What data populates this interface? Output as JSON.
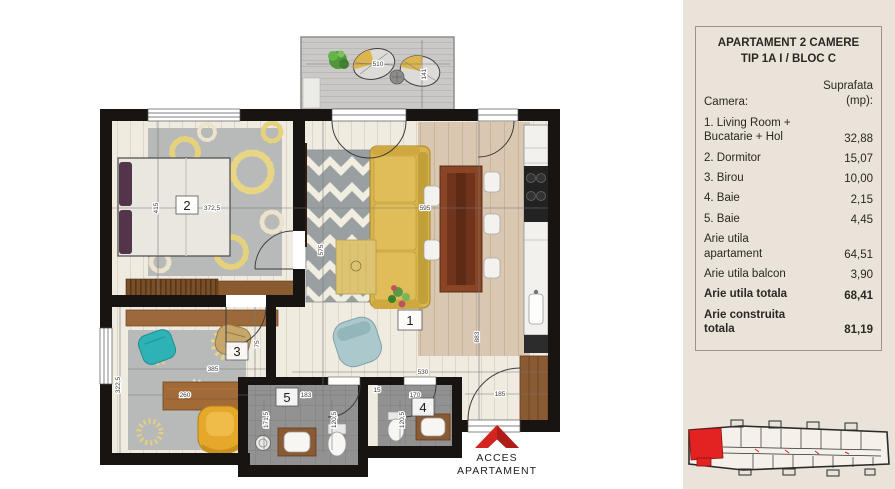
{
  "colors": {
    "accent_red": "#d42420",
    "panel_beige": "#eae3da",
    "wall_black": "#171412",
    "wood": "#9c6a3a",
    "sofa_yellow": "#d8b44b",
    "rug_gray": "#b7bab9"
  },
  "side_panel": {
    "title_line1": "APARTAMENT 2 CAMERE",
    "title_line2": "TIP 1A I / BLOC C",
    "header_camera": "Camera:",
    "header_area_line1": "Suprafata",
    "header_area_line2": "(mp):",
    "rows": [
      {
        "label": "1. Living Room +\nBucatarie + Hol",
        "value": "32,88"
      },
      {
        "label": "2. Dormitor",
        "value": "15,07"
      },
      {
        "label": "3. Birou",
        "value": "10,00"
      },
      {
        "label": "4. Baie",
        "value": "2,15"
      },
      {
        "label": "5. Baie",
        "value": "4,45"
      },
      {
        "label": "Arie utila\napartament",
        "value": "64,51"
      },
      {
        "label": "Arie utila balcon",
        "value": "3,90"
      },
      {
        "label": "Arie utila totala",
        "value": "68,41"
      },
      {
        "label": "Arie construita\ntotala",
        "value": "81,19"
      }
    ]
  },
  "plan": {
    "rooms": {
      "living": "1",
      "dormitor": "2",
      "birou": "3",
      "baie4": "4",
      "baie5": "5"
    },
    "access_line1": "ACCES",
    "access_line2": "APARTAMENT",
    "dims": {
      "balcony_w": "510",
      "balcony_d": "141",
      "dorm_w": "372,5",
      "dorm_h": "415",
      "living_w": "595",
      "living_h": "575",
      "total_h": "883",
      "birou_w": "385",
      "desk_w": "260",
      "birou_h": "322,5",
      "door_w": "75",
      "hall_w": "530",
      "bath5_w": "183",
      "bath5_h": "171,5",
      "bath5_d": "120,5",
      "bath4_w": "170",
      "bath4_d": "120,5",
      "entry_w": "185",
      "wall_t": "15"
    }
  }
}
